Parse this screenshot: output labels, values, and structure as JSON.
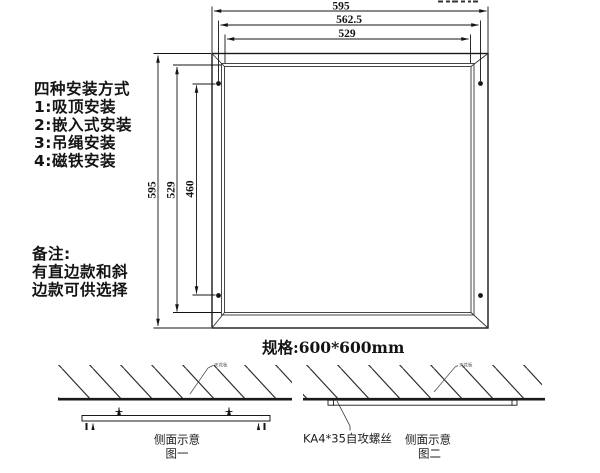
{
  "page": {
    "background": "#ffffff",
    "ink": "#1a1a1a"
  },
  "install": {
    "title": "四种安装方式",
    "items": [
      "1:吸顶安装",
      "2:嵌入式安装",
      "3:吊绳安装",
      "4:磁铁安装"
    ]
  },
  "note": {
    "title": "备注:",
    "lines": [
      "有直边款和斜",
      "边款可供选择"
    ]
  },
  "spec_label": "规格:600*600mm",
  "drawing": {
    "dim_width_outer": "595",
    "dim_width_holes": "562.5",
    "dim_width_inner": "529",
    "dim_height_outer": "595",
    "dim_height_inner": "529",
    "dim_height_holes": "460"
  },
  "figure1": {
    "caption": "侧面示意",
    "number": "图一",
    "ceiling_label": "天花板"
  },
  "figure2": {
    "caption": "侧面示意",
    "number": "图二",
    "screw_label": "KA4*35自攻螺丝",
    "ceiling_label": "天花板"
  }
}
